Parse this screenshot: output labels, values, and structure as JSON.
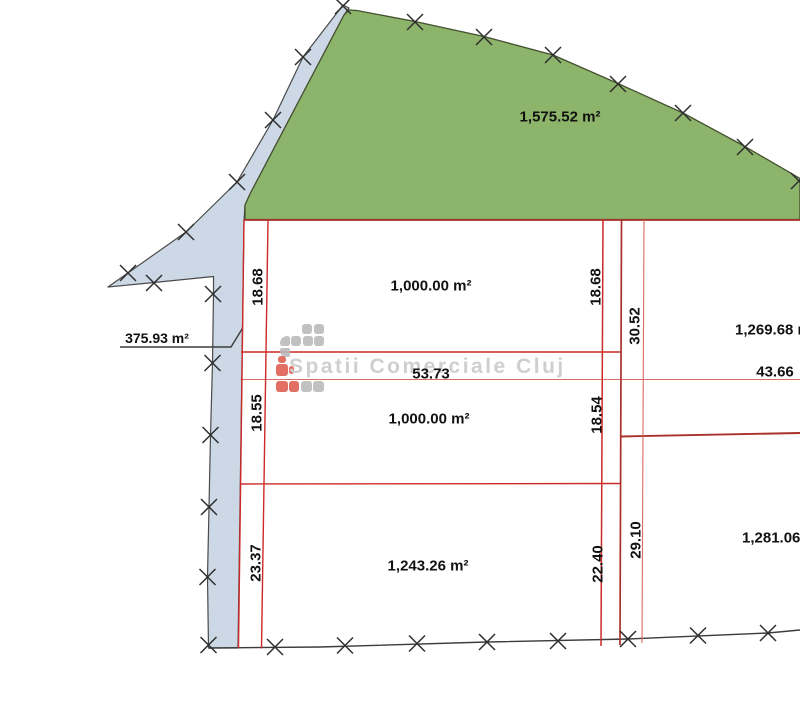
{
  "watermark": {
    "text": "Spatii Comerciale Cluj",
    "logo_blocks": [
      {
        "x": 302,
        "y": 324,
        "w": 10,
        "h": 10,
        "c": "gray"
      },
      {
        "x": 313.5,
        "y": 324,
        "w": 10,
        "h": 10,
        "c": "gray"
      },
      {
        "x": 279.5,
        "y": 336,
        "w": 10,
        "h": 10,
        "c": "gray",
        "r": "8px 3px 3px 3px"
      },
      {
        "x": 291,
        "y": 336,
        "w": 10,
        "h": 10,
        "c": "gray"
      },
      {
        "x": 302.5,
        "y": 336,
        "w": 10,
        "h": 10,
        "c": "gray"
      },
      {
        "x": 314,
        "y": 336,
        "w": 10,
        "h": 10,
        "c": "gray"
      },
      {
        "x": 279.5,
        "y": 347.5,
        "w": 10,
        "h": 9,
        "c": "gray",
        "r": "2px 2px 2px 6px"
      },
      {
        "x": 277.5,
        "y": 355.5,
        "w": 8,
        "h": 7.5,
        "c": "red"
      },
      {
        "x": 275.5,
        "y": 364,
        "w": 12,
        "h": 11.5,
        "c": "red"
      },
      {
        "x": 288.5,
        "y": 366,
        "w": 5,
        "h": 8,
        "c": "red"
      },
      {
        "x": 275.5,
        "y": 381,
        "w": 12,
        "h": 11,
        "c": "red"
      },
      {
        "x": 288.5,
        "y": 381,
        "w": 10.5,
        "h": 11,
        "c": "red"
      },
      {
        "x": 300.5,
        "y": 381,
        "w": 11,
        "h": 11,
        "c": "gray"
      },
      {
        "x": 313,
        "y": 381,
        "w": 11,
        "h": 11,
        "c": "gray"
      }
    ]
  },
  "colors": {
    "red_main": "#cc2a28",
    "red_dark": "#a8322a",
    "red_light": "#d96a66",
    "black_line": "#3c3c3c",
    "marker": "#2e2e2e",
    "green_fill": "#8db46b",
    "green_stroke": "#44502f",
    "blue_fill": "#cdd8e6",
    "blue_stroke": "#4a4a4a",
    "logo_gray": "#b9b9b9",
    "logo_red": "#dd5c4f"
  },
  "plan": {
    "canvas": {
      "width": 800,
      "height": 720
    },
    "green_area": {
      "points": [
        [
          245,
          219.5
        ],
        [
          245,
          205
        ],
        [
          250,
          194
        ],
        [
          344,
          15
        ],
        [
          349,
          10
        ],
        [
          357,
          10.5
        ],
        [
          415,
          21.5
        ],
        [
          484,
          36.5
        ],
        [
          553,
          55
        ],
        [
          618,
          83.5
        ],
        [
          683,
          113
        ],
        [
          745,
          146.5
        ],
        [
          800,
          178.5
        ],
        [
          800,
          219.5
        ]
      ]
    },
    "buffer_strip": {
      "points": [
        [
          343,
          5
        ],
        [
          303,
          57
        ],
        [
          273,
          120
        ],
        [
          237,
          182
        ],
        [
          186,
          232
        ],
        [
          108,
          287
        ],
        [
          154,
          282.5
        ],
        [
          213.5,
          276.5
        ],
        [
          213.5,
          294
        ],
        [
          212.5,
          363
        ],
        [
          210.5,
          435
        ],
        [
          209,
          507
        ],
        [
          207.5,
          577
        ],
        [
          208.5,
          648
        ],
        [
          238,
          648
        ],
        [
          244,
          221
        ],
        [
          245,
          205
        ],
        [
          250,
          194
        ],
        [
          344,
          15
        ],
        [
          349,
          8
        ]
      ]
    },
    "red_lines": [
      {
        "x1": 244,
        "y1": 220,
        "x2": 800,
        "y2": 220,
        "w": 1.7,
        "c": "red_dark"
      },
      {
        "x1": 241,
        "y1": 352,
        "x2": 621,
        "y2": 352,
        "w": 1.4,
        "c": "red_main"
      },
      {
        "x1": 240.5,
        "y1": 379.5,
        "x2": 800,
        "y2": 379.5,
        "w": 1.1,
        "c": "red_light"
      },
      {
        "x1": 621,
        "y1": 436.5,
        "x2": 800,
        "y2": 433,
        "w": 1.9,
        "c": "red_dark"
      },
      {
        "x1": 240,
        "y1": 484,
        "x2": 621,
        "y2": 483.5,
        "w": 1.4,
        "c": "red_main"
      },
      {
        "x1": 244,
        "y1": 220,
        "x2": 238.5,
        "y2": 648,
        "w": 1.4,
        "c": "red_main"
      },
      {
        "x1": 268,
        "y1": 220,
        "x2": 261.5,
        "y2": 648.5,
        "w": 1.4,
        "c": "red_main"
      },
      {
        "x1": 603,
        "y1": 220,
        "x2": 601,
        "y2": 646,
        "w": 1.5,
        "c": "red_main"
      },
      {
        "x1": 621.5,
        "y1": 220,
        "x2": 620,
        "y2": 645,
        "w": 1.7,
        "c": "red_dark"
      },
      {
        "x1": 644,
        "y1": 220,
        "x2": 642,
        "y2": 643,
        "w": 1.1,
        "c": "red_light"
      }
    ],
    "black_polylines": [
      {
        "name": "south-boundary-line",
        "points": [
          [
            208.5,
            648
          ],
          [
            320,
            647
          ],
          [
            487,
            642
          ],
          [
            628,
            639
          ],
          [
            768,
            633
          ],
          [
            800,
            630
          ]
        ]
      },
      {
        "name": "area-leader-line",
        "points": [
          [
            120,
            347
          ],
          [
            231,
            347
          ],
          [
            243,
            327.5
          ]
        ]
      }
    ],
    "survey_markers": [
      [
        343,
        6
      ],
      [
        303,
        57
      ],
      [
        273,
        120
      ],
      [
        237,
        182
      ],
      [
        186,
        232
      ],
      [
        128,
        273
      ],
      [
        154,
        283
      ],
      [
        213,
        294
      ],
      [
        212.5,
        363
      ],
      [
        210.5,
        435
      ],
      [
        209,
        507
      ],
      [
        207.5,
        577
      ],
      [
        208.5,
        645
      ],
      [
        415,
        22
      ],
      [
        484,
        37
      ],
      [
        553,
        55
      ],
      [
        618,
        84
      ],
      [
        683,
        113
      ],
      [
        745,
        147
      ],
      [
        799,
        181
      ],
      [
        275,
        647
      ],
      [
        345,
        645.5
      ],
      [
        417,
        643.5
      ],
      [
        487,
        642
      ],
      [
        558,
        641
      ],
      [
        628,
        639
      ],
      [
        698,
        635.5
      ],
      [
        768,
        633
      ]
    ],
    "labels": [
      {
        "text": "1,575.52 m²",
        "x": 560,
        "y": 117,
        "type": "area"
      },
      {
        "text": "375.93 m²",
        "x": 157,
        "y": 338,
        "type": "area",
        "size": 14
      },
      {
        "text": "1,000.00 m²",
        "x": 431,
        "y": 286,
        "type": "area"
      },
      {
        "text": "1,000.00 m²",
        "x": 429,
        "y": 419,
        "type": "area"
      },
      {
        "text": "1,243.26 m²",
        "x": 428,
        "y": 566,
        "type": "area"
      },
      {
        "text": "1,269.68 m²",
        "x": 735,
        "y": 330,
        "type": "area",
        "anchor": "left"
      },
      {
        "text": "1,281.06 m²",
        "x": 742,
        "y": 538,
        "type": "area",
        "anchor": "left"
      },
      {
        "text": "53.73",
        "x": 431,
        "y": 373.5,
        "type": "dimension"
      },
      {
        "text": "43.66",
        "x": 775,
        "y": 372,
        "type": "dimension"
      },
      {
        "text": "18.68",
        "x": 257.5,
        "y": 287,
        "type": "dimension",
        "rot": -90
      },
      {
        "text": "18.68",
        "x": 596,
        "y": 287,
        "type": "dimension",
        "rot": -90
      },
      {
        "text": "30.52",
        "x": 635,
        "y": 326,
        "type": "dimension",
        "rot": -90
      },
      {
        "text": "18.55",
        "x": 257,
        "y": 413,
        "type": "dimension",
        "rot": -90
      },
      {
        "text": "18.54",
        "x": 596.5,
        "y": 415,
        "type": "dimension",
        "rot": -90
      },
      {
        "text": "23.37",
        "x": 256,
        "y": 562.5,
        "type": "dimension",
        "rot": -90
      },
      {
        "text": "22.40",
        "x": 598,
        "y": 564,
        "type": "dimension",
        "rot": -90
      },
      {
        "text": "29.10",
        "x": 636,
        "y": 540,
        "type": "dimension",
        "rot": -90
      }
    ]
  }
}
